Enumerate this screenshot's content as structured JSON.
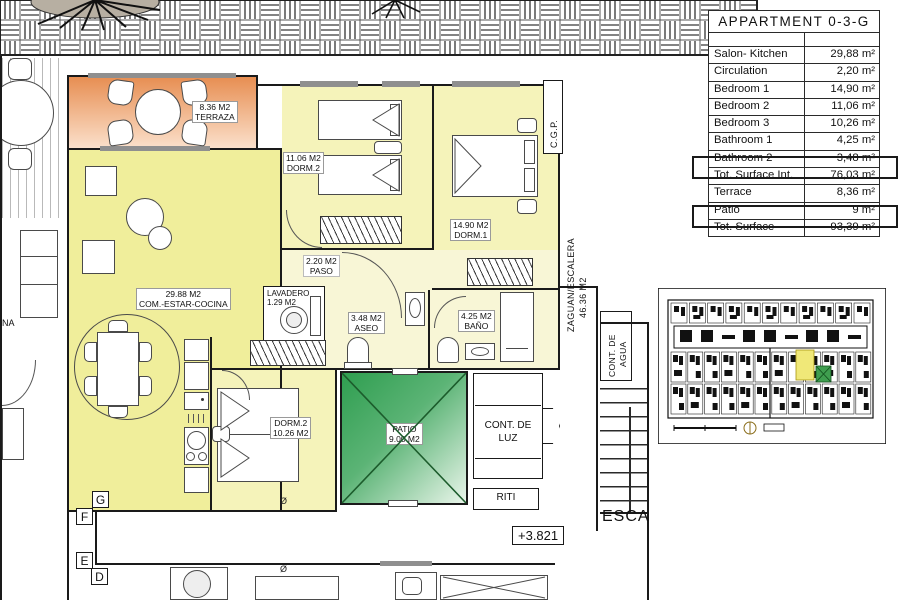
{
  "title_block": {
    "title": "APPARTMENT 0-3-G",
    "rows": [
      {
        "label": "Salon- Kitchen",
        "value": "29,88 m²"
      },
      {
        "label": "Circulation",
        "value": "2,20 m²"
      },
      {
        "label": "Bedroom 1",
        "value": "14,90 m²"
      },
      {
        "label": "Bedroom 2",
        "value": "11,06 m²"
      },
      {
        "label": "Bedroom 3",
        "value": "10,26 m²"
      },
      {
        "label": "Bathroom 1",
        "value": "4,25 m²"
      },
      {
        "label": "Bathroom 2",
        "value": "3,48 m²"
      },
      {
        "label": "Tot. Surface Int.",
        "value": "76,03 m²",
        "boxed": true
      },
      {
        "label": "Terrace",
        "value": "8,36 m²"
      },
      {
        "label": "Patio",
        "value": "9 m²"
      },
      {
        "label": "Tot. Surface",
        "value": "93,39 m²",
        "boxed": true
      }
    ]
  },
  "rooms": {
    "terrace": {
      "area": "8.36 M2",
      "name": "TERRAZA"
    },
    "living": {
      "area": "29.88 M2",
      "name": "COM.-ESTAR-COCINA"
    },
    "bedroom2": {
      "area": "11.06 M2",
      "name": "DORM.2"
    },
    "bedroom1": {
      "area": "14.90 M2",
      "name": "DORM.1"
    },
    "hall": {
      "area": "2.20 M2",
      "name": "PASO"
    },
    "laundry": {
      "name": "LAVADERO",
      "area": "1.29 M2"
    },
    "toilet": {
      "area": "3.48 M2",
      "name": "ASEO"
    },
    "bath": {
      "area": "4.25 M2",
      "name": "BAÑO"
    },
    "bedroom3": {
      "name": "DORM.2",
      "area": "10.26 M2"
    },
    "patio": {
      "name": "PATIO",
      "area": "9.00 M2"
    }
  },
  "annotations": {
    "electric_meter_l1": "CONT. DE",
    "electric_meter_l2": "LUZ",
    "riti": "RITI",
    "cgp": "C.G.P.",
    "hallway": "ZAGUAN/ESCALERA",
    "hallway_area": "46.36 M2",
    "water_meter_l1": "CONT. DE",
    "water_meter_l2": "AGUA",
    "stair": "ESCA",
    "level": "+3.821",
    "unit_letters": [
      "G",
      "F",
      "E",
      "D"
    ],
    "edge_text": "NA",
    "diameter": "Ø"
  },
  "colors": {
    "room_yellow": "#f5f3ba",
    "living_yellow": "#f0ee9b",
    "hall_yellow": "#f8f6d6",
    "terrace_orange": "#e78e52",
    "patio_green": "#2f9e50",
    "wall": "#1a1a1a"
  }
}
